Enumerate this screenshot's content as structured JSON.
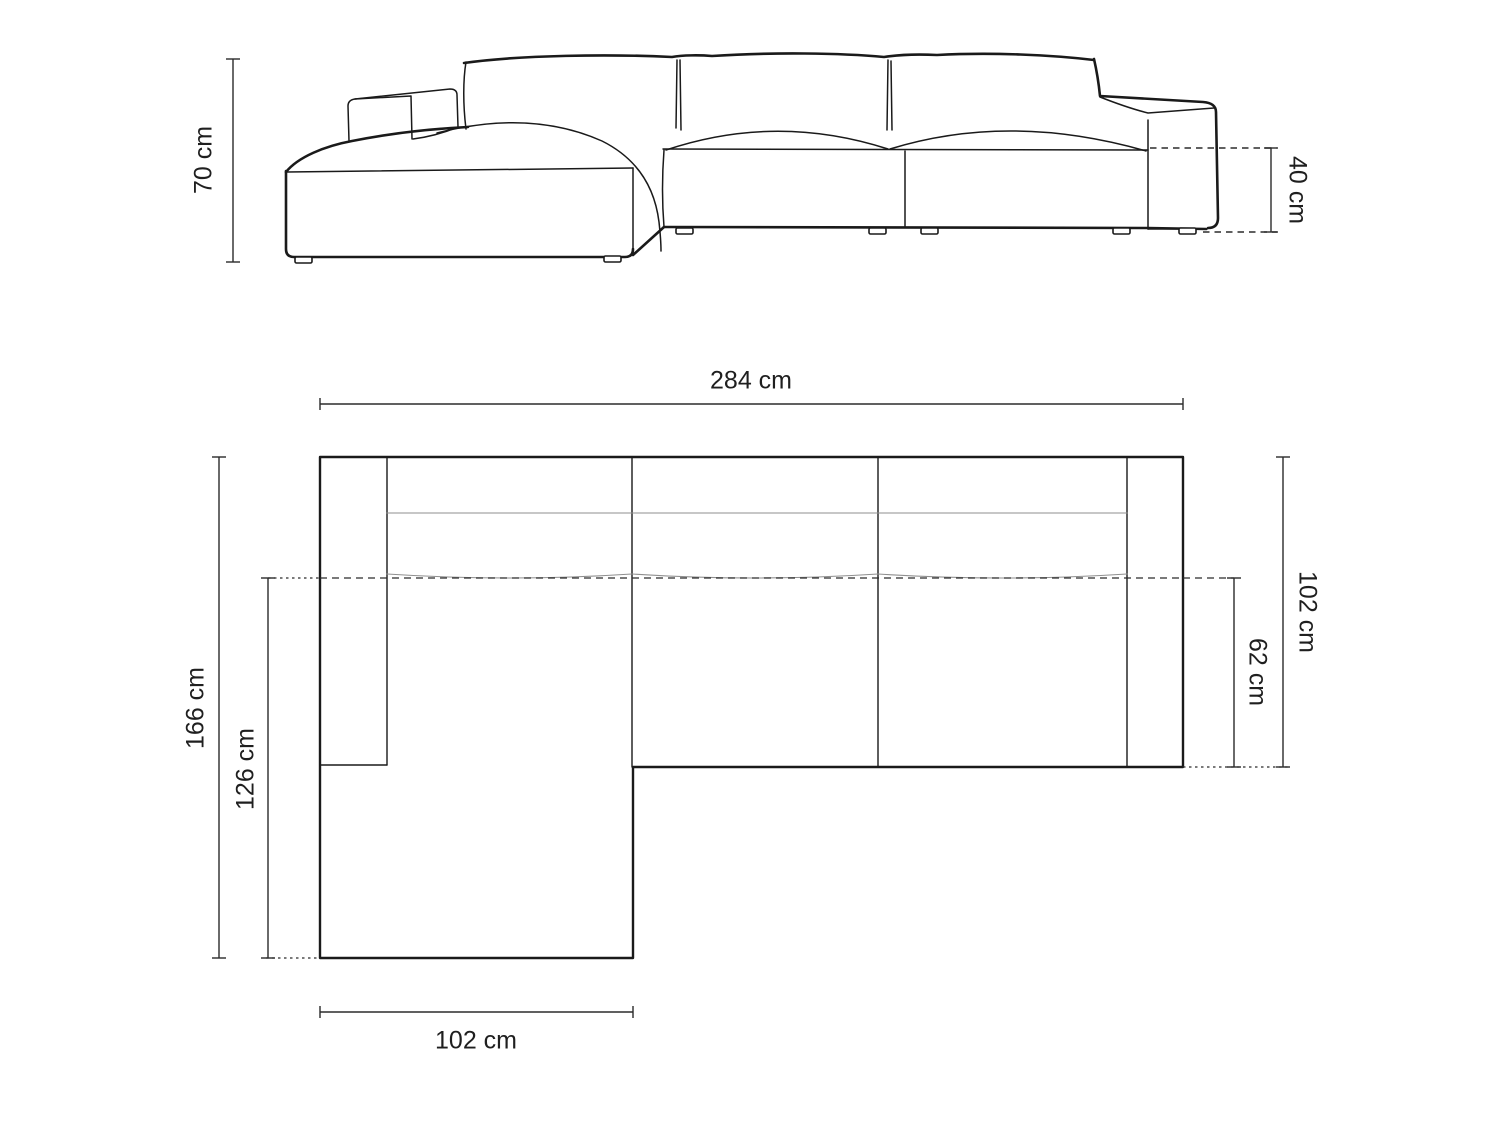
{
  "diagram": {
    "title": "corner-sofa-dimension-diagram",
    "unit": "cm",
    "colors": {
      "background": "#ffffff",
      "outline": "#1a1a1a",
      "soft_line": "#8f8f8f",
      "dimension_line": "#2b2b2b",
      "text": "#1f1f1f"
    },
    "front_view": {
      "name": "front-elevation-view",
      "dims": {
        "height": {
          "label": "70 cm",
          "value": 70,
          "side": "left"
        },
        "seat_height": {
          "label": "40 cm",
          "value": 40,
          "side": "right"
        }
      }
    },
    "top_view": {
      "name": "top-plan-view",
      "dims": {
        "total_width": {
          "label": "284 cm",
          "value": 284,
          "side": "top"
        },
        "total_depth": {
          "label": "166 cm",
          "value": 166,
          "side": "left"
        },
        "chaise_extent": {
          "label": "126 cm",
          "value": 126,
          "side": "left"
        },
        "body_depth": {
          "label": "102 cm",
          "value": 102,
          "side": "right"
        },
        "seat_depth": {
          "label": "62 cm",
          "value": 62,
          "side": "right"
        },
        "chaise_width": {
          "label": "102 cm",
          "value": 102,
          "side": "bottom"
        }
      }
    }
  }
}
